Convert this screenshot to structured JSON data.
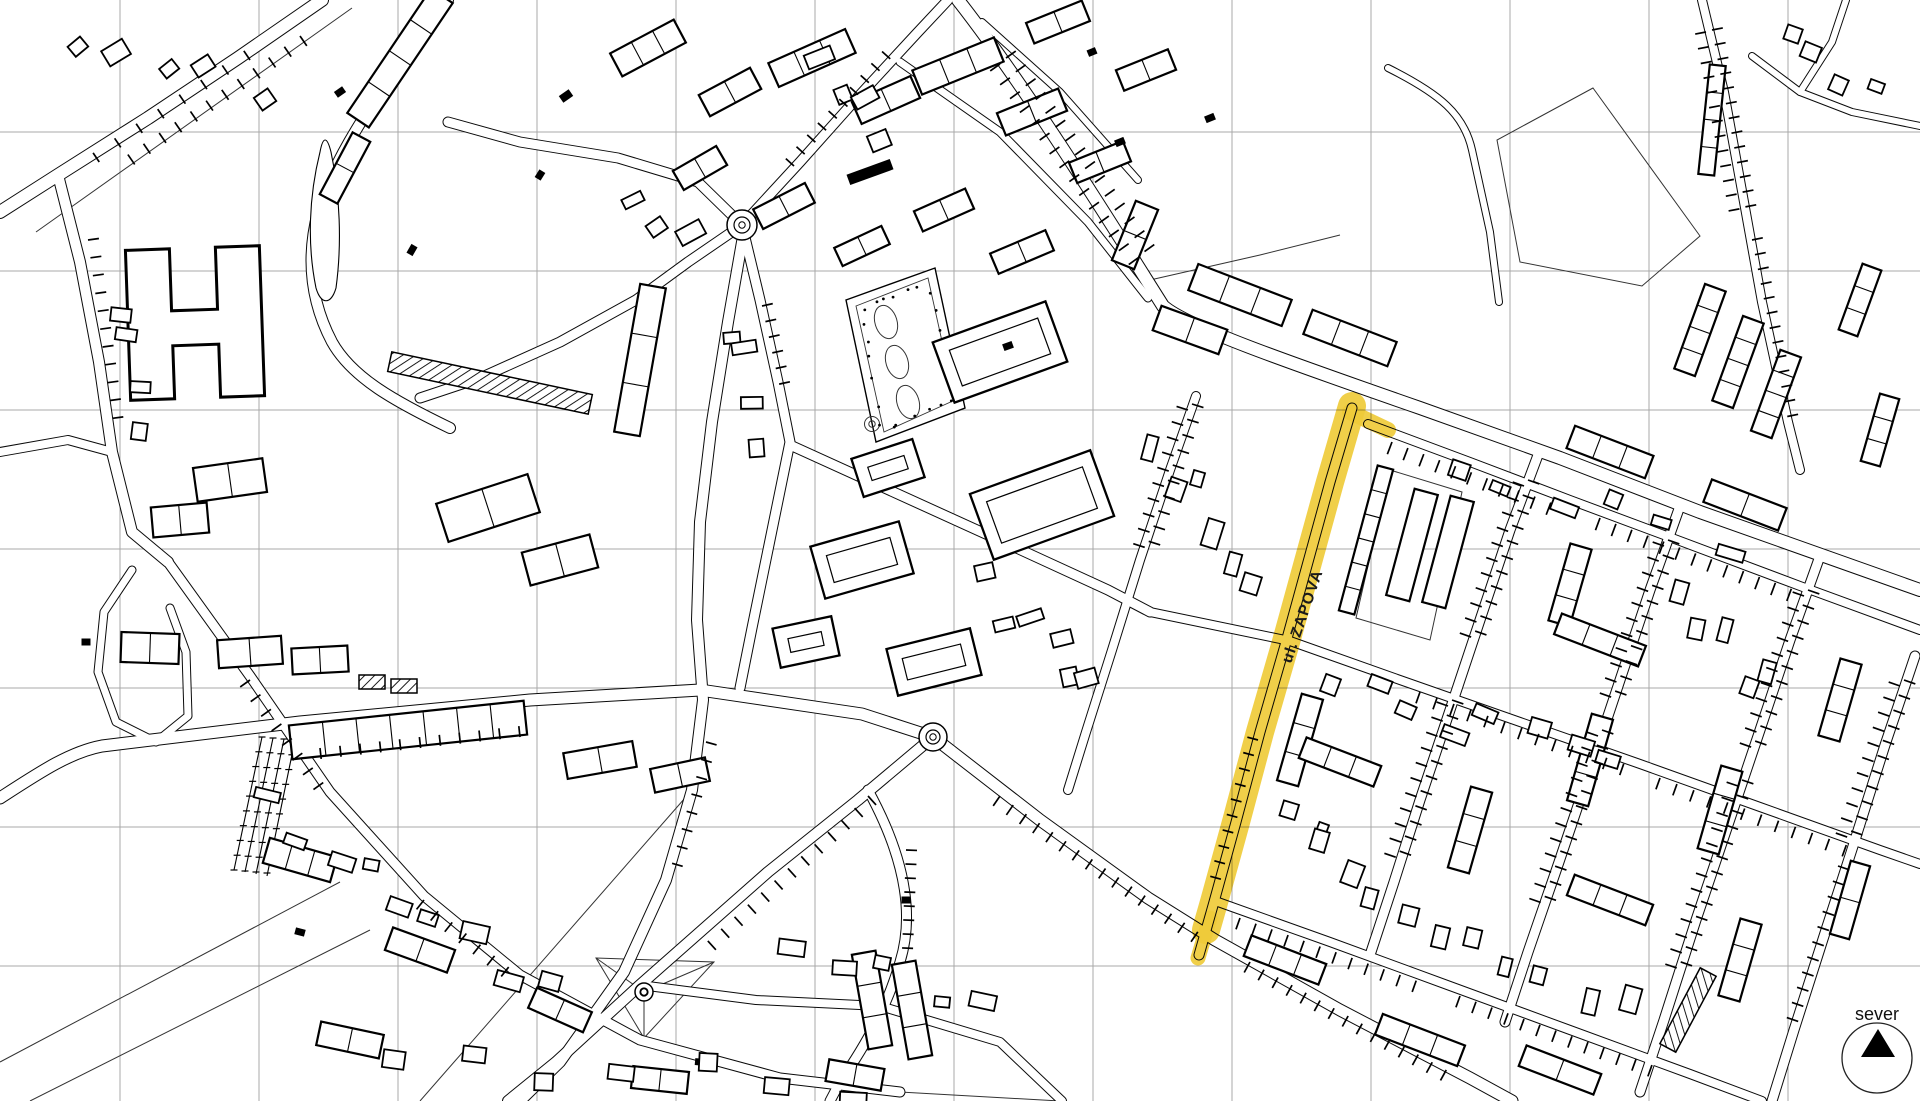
{
  "map": {
    "highlight": {
      "label": "ul. ZAPOVA",
      "color": "#EFCB3A"
    },
    "compass": {
      "label": "sever",
      "icon": "north-arrow-icon"
    },
    "colors": {
      "background": "#ffffff",
      "linework": "#000000",
      "grid": "#a9a9a9"
    }
  }
}
